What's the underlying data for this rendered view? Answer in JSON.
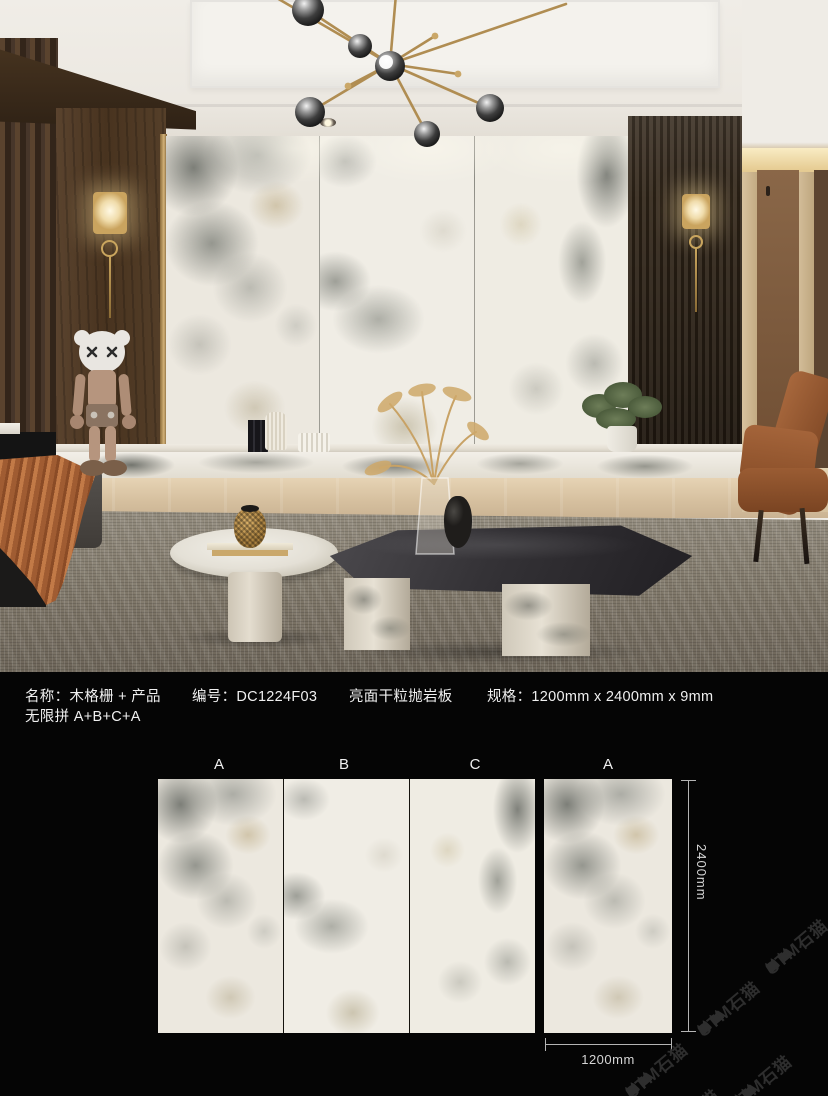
{
  "info": {
    "name_label": "名称：木格栅 + 产品",
    "code_label": "编号：DC1224F03",
    "finish_label": "亮面干粒抛岩板",
    "spec_label": "规格：1200mm x 2400mm x 9mm",
    "combo_label": "无限拼 A+B+C+A"
  },
  "diagram": {
    "labels": [
      "A",
      "B",
      "C",
      "A"
    ],
    "height_dim": "2400mm",
    "width_dim": "1200mm"
  },
  "watermark": {
    "text": "STM石猫"
  },
  "colors": {
    "background": "#050505",
    "text": "#f0f0f0",
    "dim_lines": "#b5b5b5",
    "accent_gold": "#b08d52",
    "marble_base": "#ece8df",
    "rug": "#8d8679",
    "leather": "#9a5c36",
    "watermark": "#2e2e2e"
  }
}
